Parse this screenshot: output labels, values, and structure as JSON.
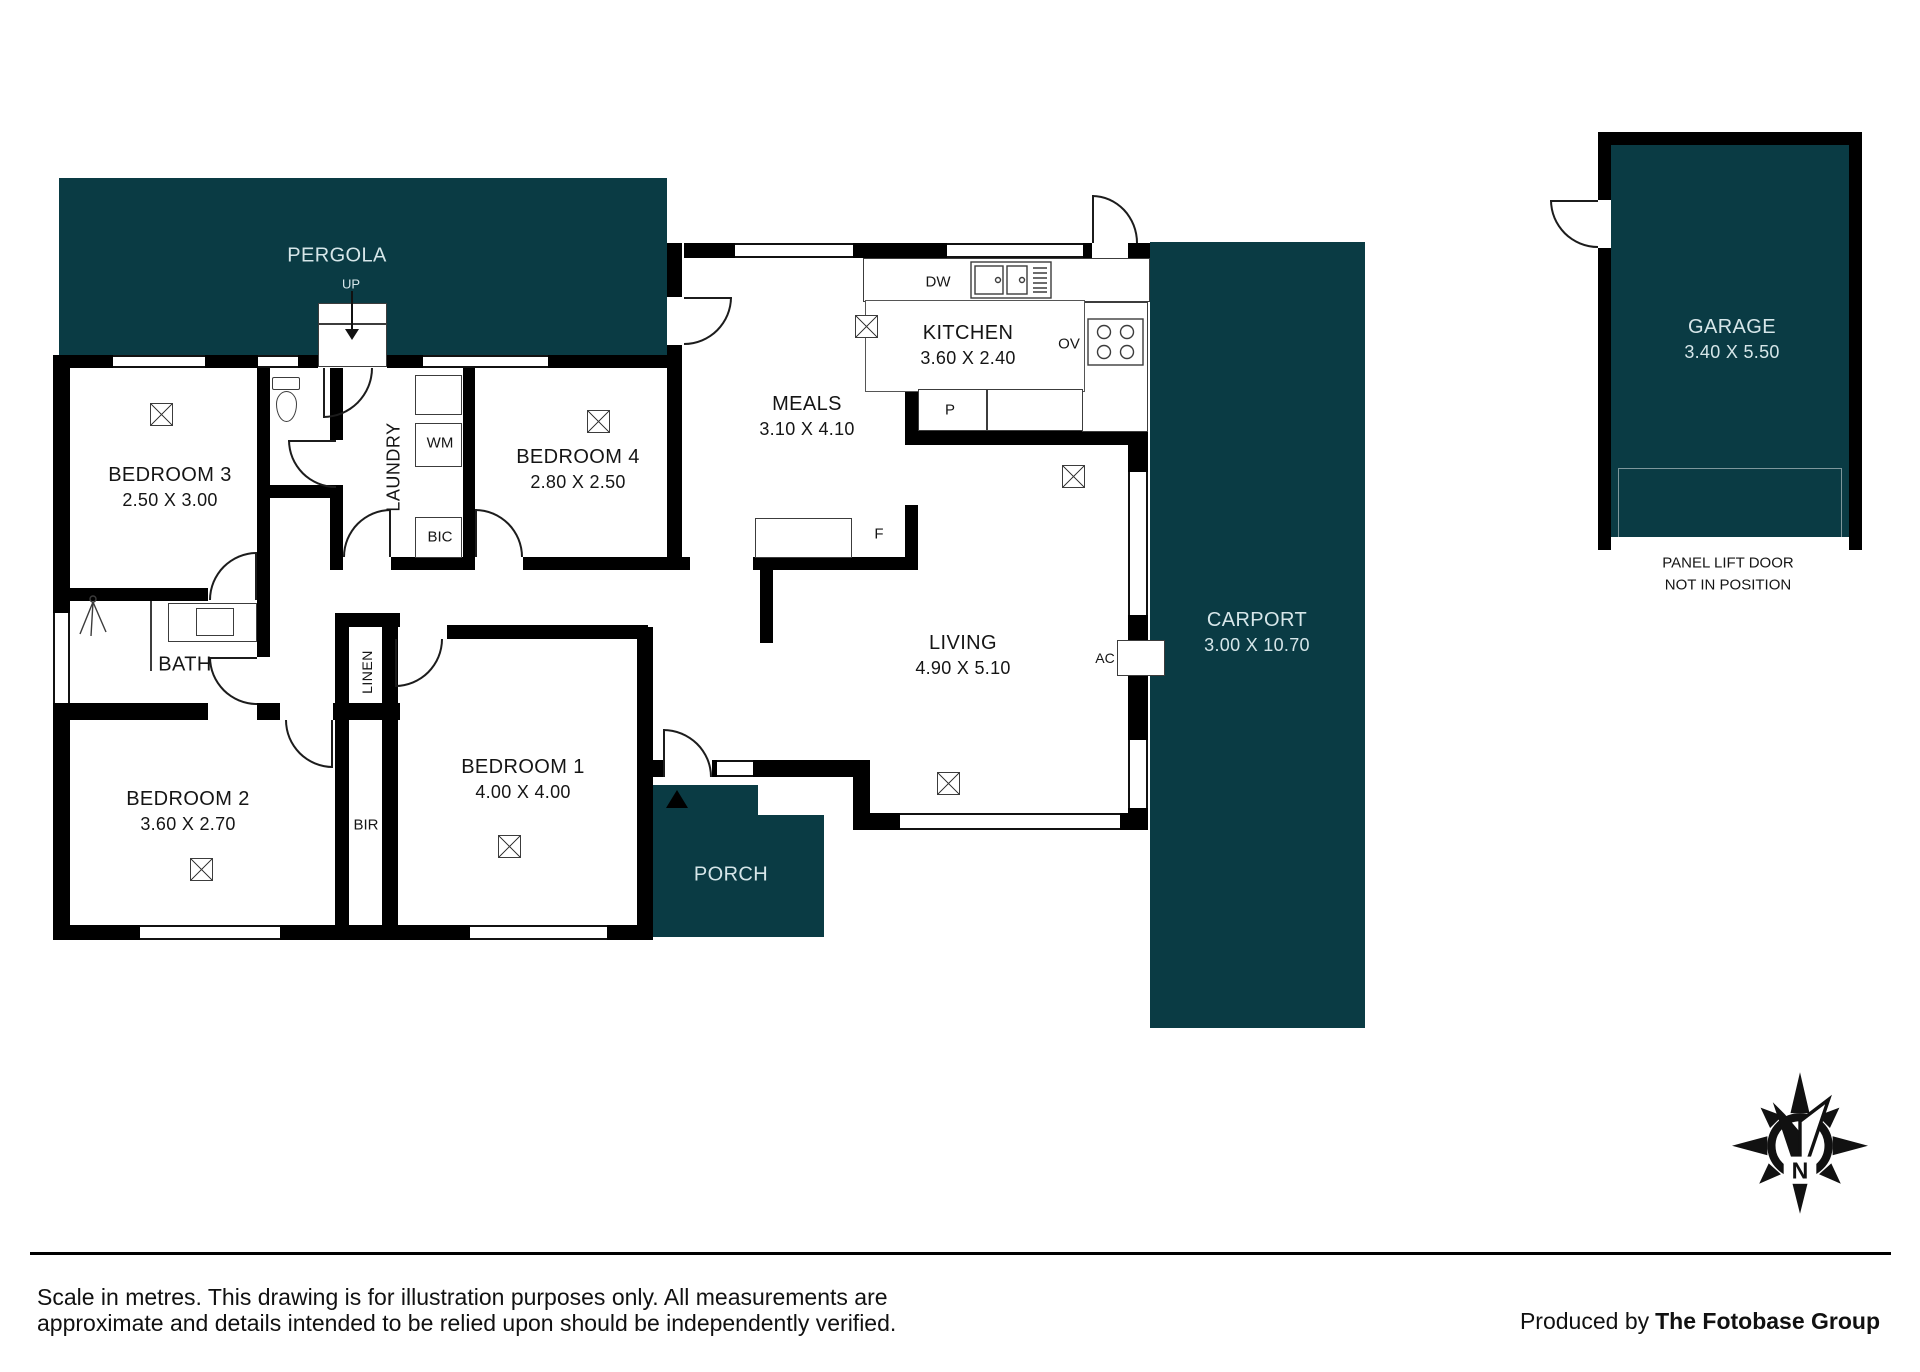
{
  "colors": {
    "accent_dark": "#0a3b44",
    "wall": "#000000",
    "thin_line": "#3c3c3c",
    "text_light": "#d6e6e9",
    "text_dark": "#151515"
  },
  "rooms": {
    "pergola": {
      "label": "PERGOLA"
    },
    "bedroom3": {
      "label": "BEDROOM 3",
      "dims": "2.50 X 3.00"
    },
    "bedroom4": {
      "label": "BEDROOM 4",
      "dims": "2.80 X 2.50"
    },
    "meals": {
      "label": "MEALS",
      "dims": "3.10 X 4.10"
    },
    "kitchen": {
      "label": "KITCHEN",
      "dims": "3.60 X 2.40"
    },
    "living": {
      "label": "LIVING",
      "dims": "4.90 X 5.10"
    },
    "bath": {
      "label": "BATH"
    },
    "bedroom2": {
      "label": "BEDROOM 2",
      "dims": "3.60 X 2.70"
    },
    "bedroom1": {
      "label": "BEDROOM 1",
      "dims": "4.00 X 4.00"
    },
    "porch": {
      "label": "PORCH"
    },
    "carport": {
      "label": "CARPORT",
      "dims": "3.00 X 10.70"
    },
    "garage": {
      "label": "GARAGE",
      "dims": "3.40 X 5.50"
    }
  },
  "fixture_labels": {
    "up": "UP",
    "wm": "WM",
    "bic": "BIC",
    "laundry": "LAUNDRY",
    "linen": "LINEN",
    "bir": "BIR",
    "dw": "DW",
    "ov": "OV",
    "pantry": "P",
    "fridge": "F",
    "ac": "AC"
  },
  "garage_note": {
    "line1": "PANEL LIFT DOOR",
    "line2": "NOT IN POSITION"
  },
  "compass": {
    "north": "N"
  },
  "footer": {
    "disclaimer_line1": "Scale in metres. This drawing is for illustration purposes only. All measurements are",
    "disclaimer_line2": "approximate and details intended to be relied upon should be independently verified.",
    "produced_by": "Produced by",
    "brand": "The Fotobase Group"
  }
}
